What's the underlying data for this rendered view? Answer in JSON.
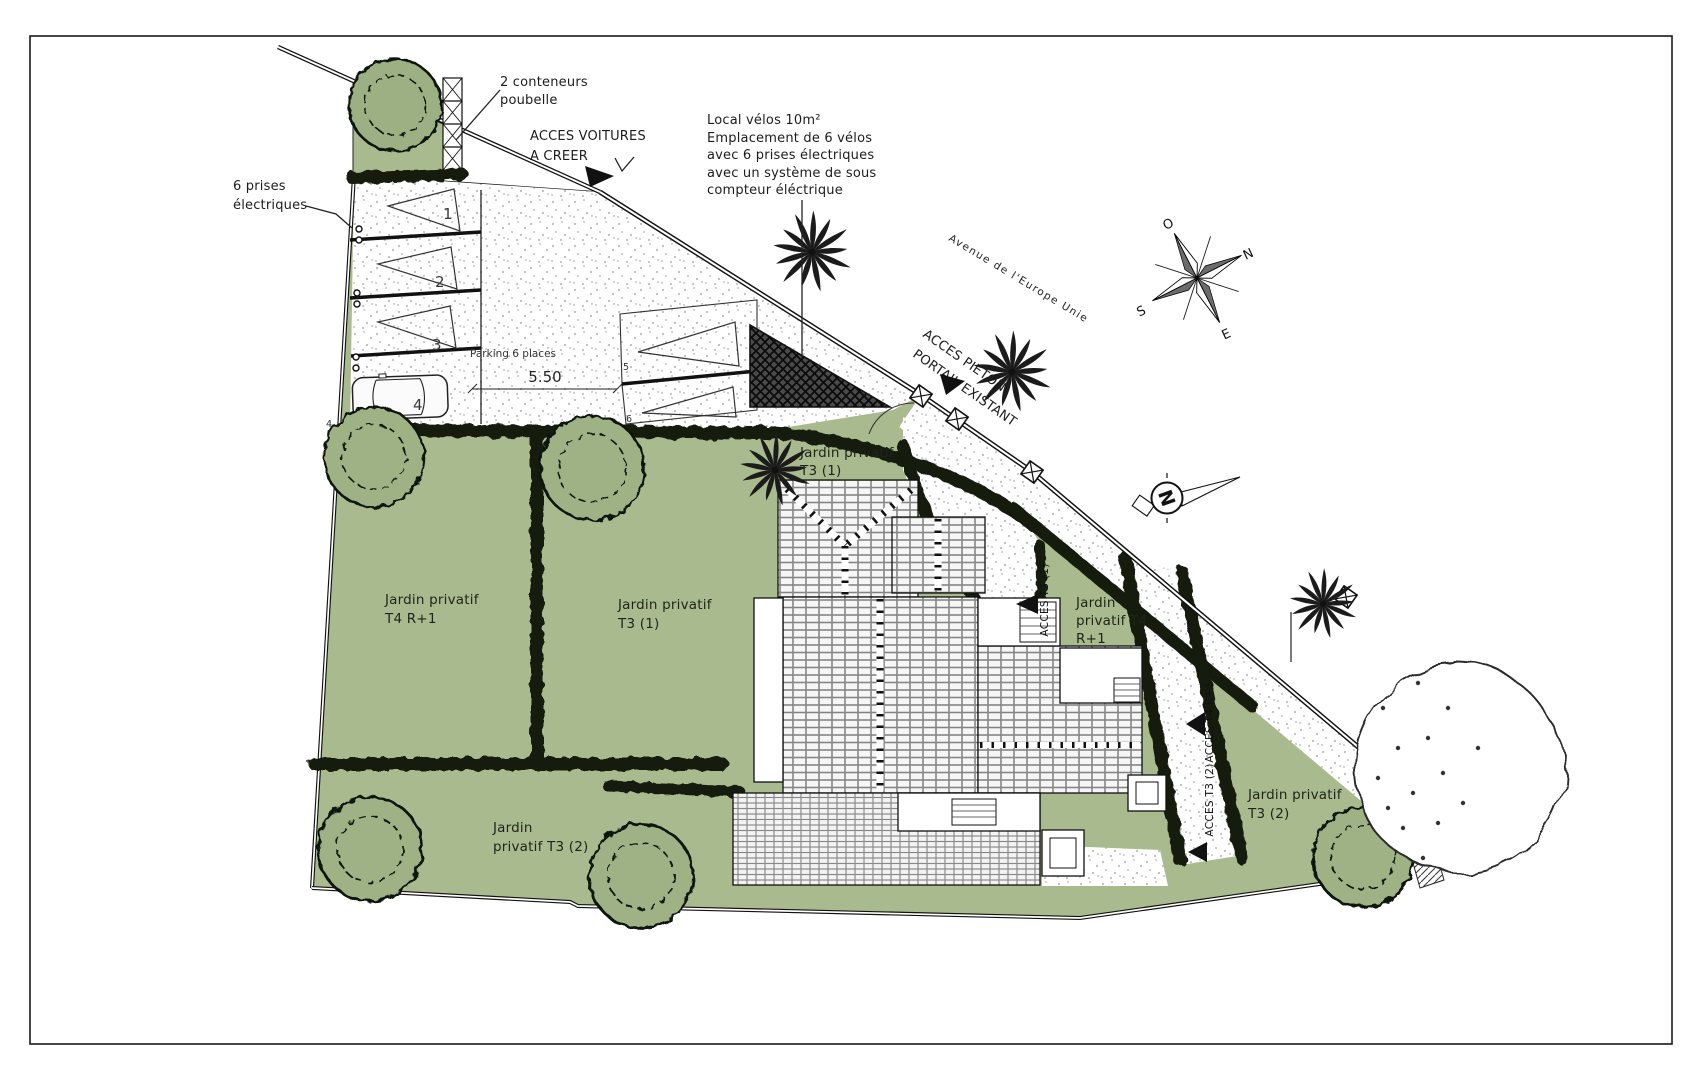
{
  "plan_title": "Plan de masse paysager",
  "colors": {
    "garden_green": "#a9ba8e",
    "hedge_dark": "#161a0e",
    "shed_dark": "#3d3d3d",
    "line_black": "#111111"
  },
  "annotations": {
    "containers_l1": "2 conteneurs",
    "containers_l2": "poubelle",
    "sockets_l1": "6 prises",
    "sockets_l2": "électriques",
    "access_cars_l1": "ACCES VOITURES",
    "access_cars_l2": "A CREER",
    "bike_l1": "Local vélos 10m²",
    "bike_l2": "Emplacement de 6 vélos",
    "bike_l3": "avec 6 prises électriques",
    "bike_l4": "avec un système de sous",
    "bike_l5": "compteur éléctrique",
    "street": "Avenue de l'Europe Unie",
    "access_ped_l1": "ACCES PIETON",
    "access_ped_l2": "PORTAIL EXISTANT",
    "parking": "Parking 6 places",
    "dimension": "5.50"
  },
  "gardens": {
    "left_l1": "Jardin privatif",
    "left_l2": "T4 R+1",
    "mid_l1": "Jardin privatif",
    "mid_l2": "T3 (1)",
    "top_l1": "Jardin privatif",
    "top_l2": "T3 (1)",
    "right_t4_l1": "Jardin",
    "right_t4_l2": "privatif T4",
    "right_t4_l3": "R+1",
    "bottom_l1": "Jardin",
    "bottom_l2": "privatif T3 (2)",
    "east_l1": "Jardin privatif",
    "east_l2": "T3 (2)"
  },
  "access_paths": {
    "t3_1": "ACCES T3 (1)",
    "t4": "ACCES T4 R+1",
    "t3_2": "ACCES T3 (2)"
  },
  "stalls": {
    "n1": "1",
    "n2": "2",
    "n3": "3",
    "n4": "4",
    "n5": "5",
    "n6": "6"
  },
  "compass": {
    "o": "O",
    "n": "N",
    "s": "S",
    "e": "E",
    "small_n": "N"
  }
}
